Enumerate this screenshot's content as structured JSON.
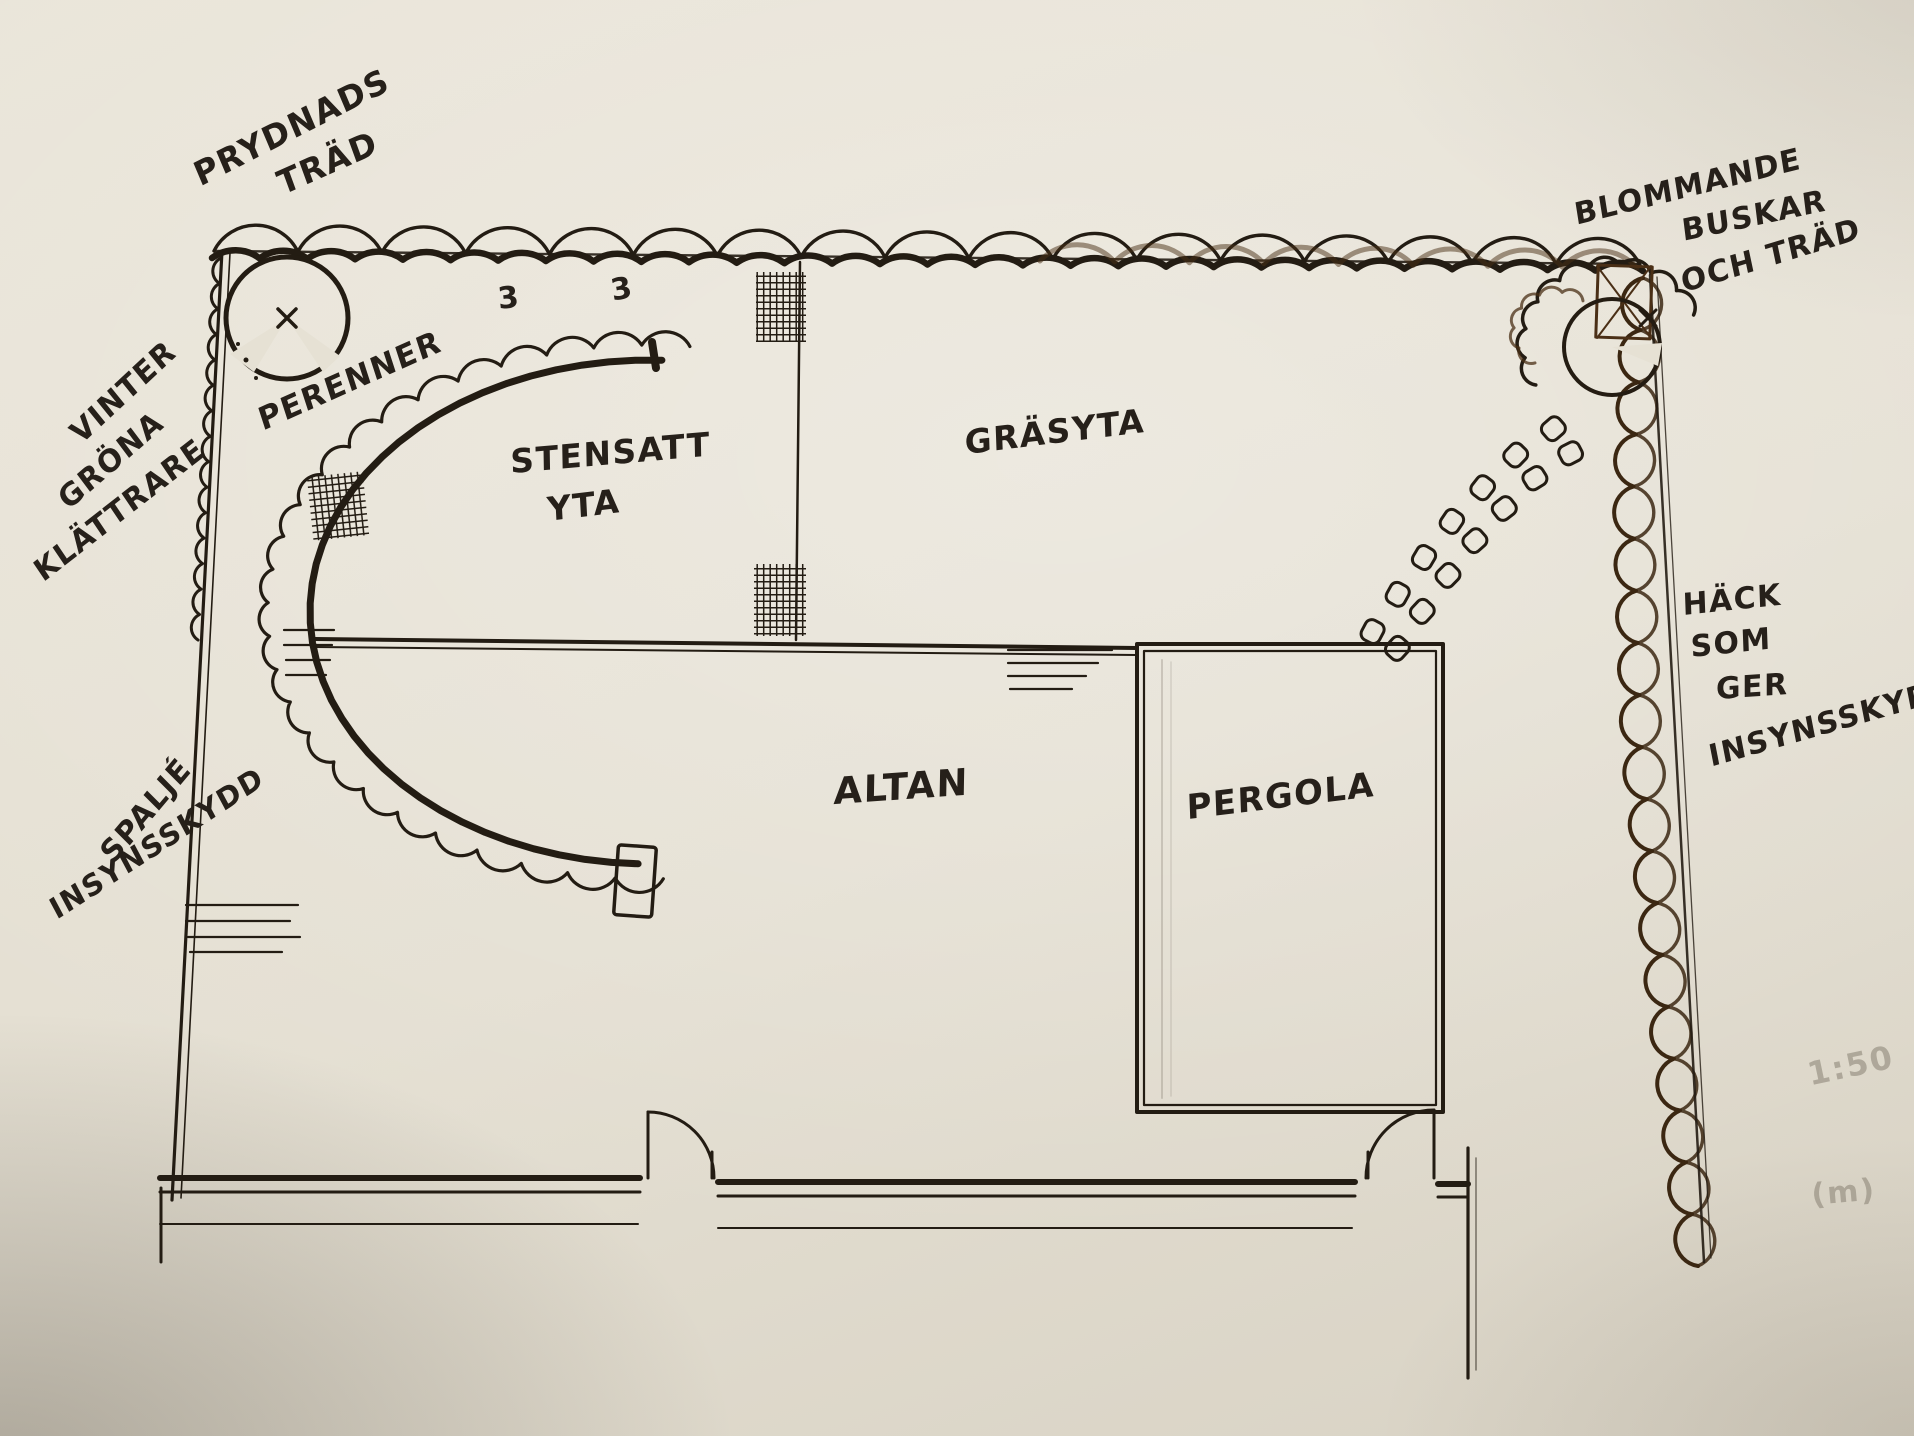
{
  "colors": {
    "ink": "#231c13",
    "hedge_brown": "#4a2f16",
    "pencil": "#8f887a",
    "paper": "#e6e1d4"
  },
  "annotations": {
    "prydnads_line1": "PRYDNADS",
    "prydnads_line2": "TRÄD",
    "vinter_line1": "VINTER",
    "vinter_line2": "GRÖNA",
    "vinter_line3": "KLÄTTRARE",
    "perenner": "PERENNER",
    "stensatt_line1": "STENSATT",
    "stensatt_line2": "YTA",
    "grasyta": "GRÄSYTA",
    "altan": "ALTAN",
    "pergola": "PERGOLA",
    "blommande_line1": "BLOMMANDE",
    "blommande_line2": "BUSKAR",
    "blommande_line3": "OCH TRÄD",
    "hack_line1": "HÄCK",
    "hack_line2": "SOM",
    "hack_line3": "GER",
    "hack_line4": "INSYNSSKYDD",
    "spalje_line1": "SPALJÉ",
    "spalje_line2": "INSYNSSKYDD",
    "count_marks": [
      "3",
      "3"
    ],
    "scale": "1:50",
    "unit": "(m)"
  }
}
